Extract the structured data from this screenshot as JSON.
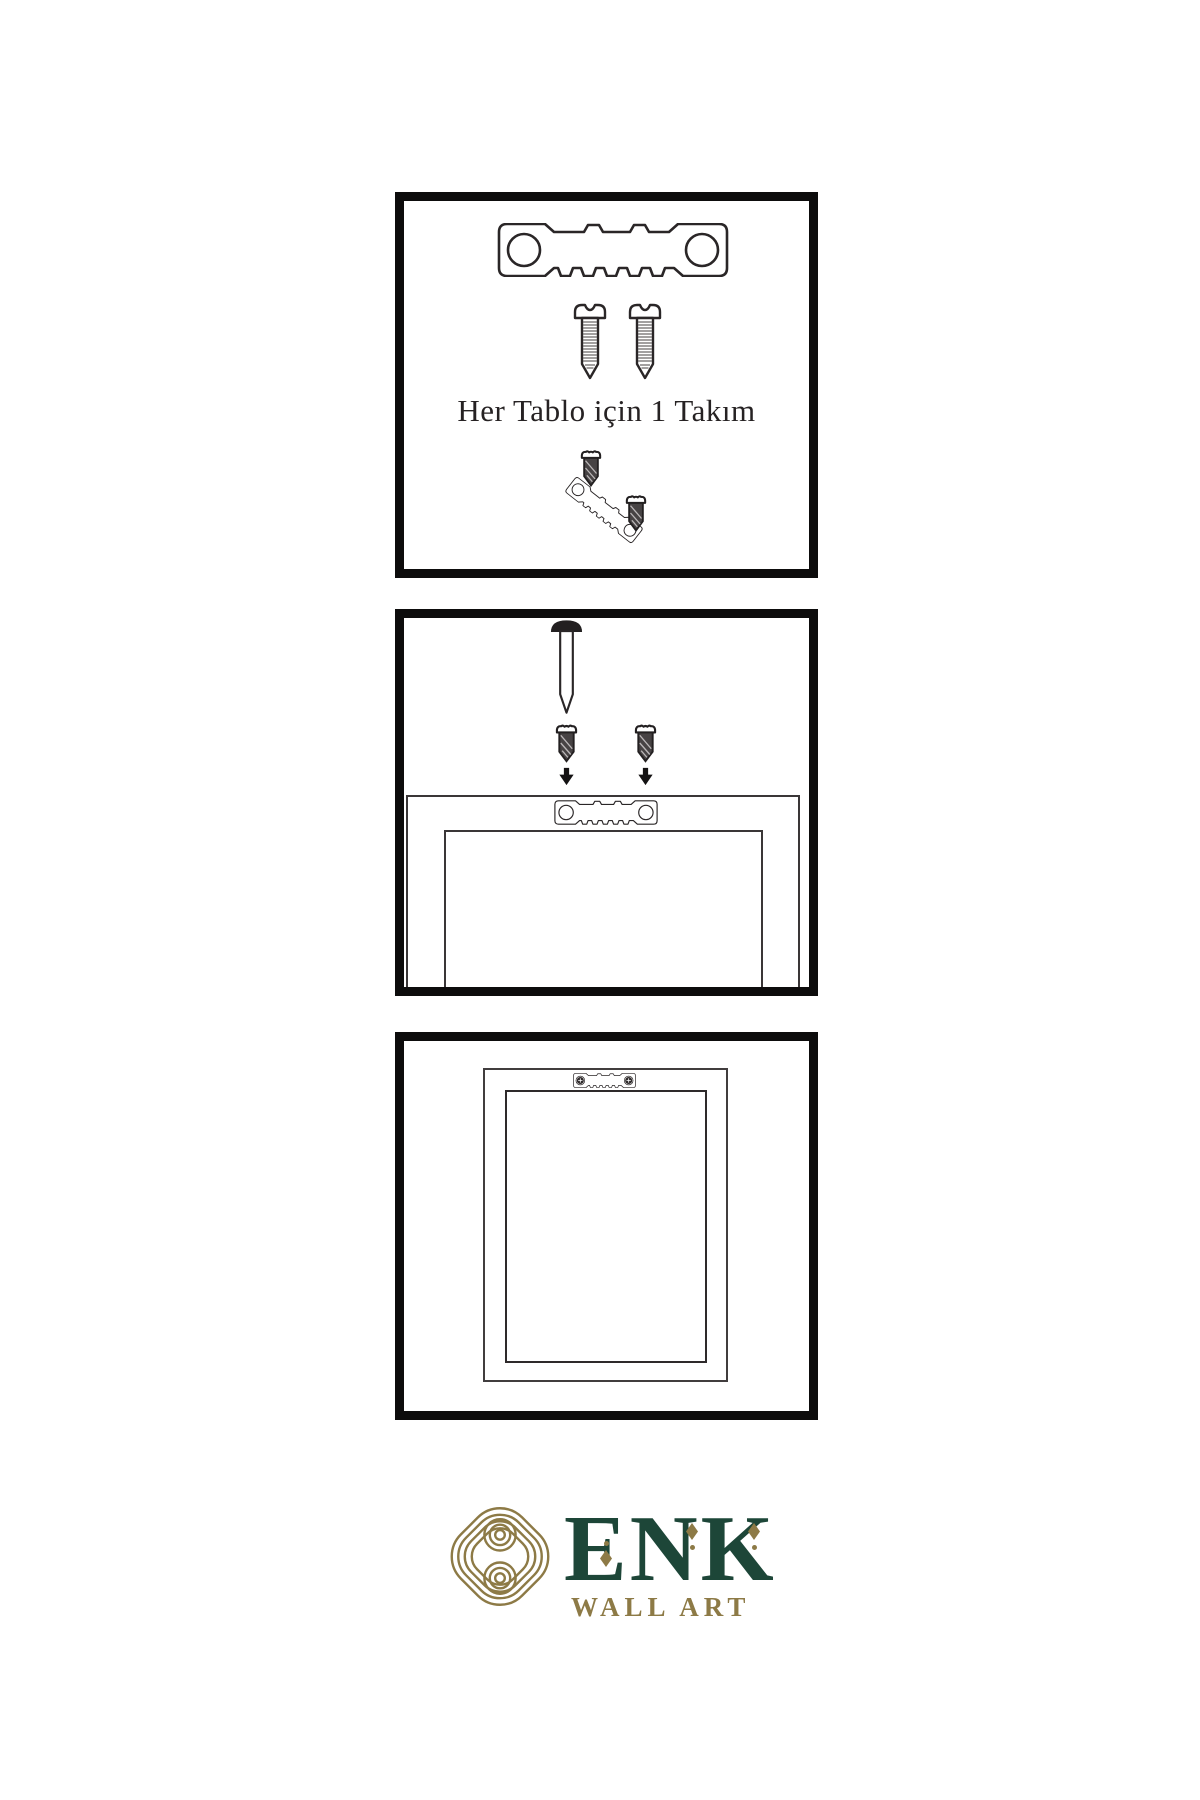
{
  "page": {
    "background": "#ffffff",
    "kind": "wall-art hanging instructions"
  },
  "step1": {
    "caption": "Her Tablo için 1 Takım",
    "icons": [
      "sawtooth-hanger-icon",
      "screw-icon",
      "screw-icon",
      "screw-dark-icon",
      "tilted-sawtooth-hanger-icon",
      "screw-dark-icon"
    ]
  },
  "step2": {
    "icons": [
      "wall-nail-icon",
      "screw-dark-icon",
      "screw-dark-icon",
      "arrow-down-icon",
      "arrow-down-icon",
      "frame-back-icon",
      "sawtooth-hanger-icon"
    ]
  },
  "step3": {
    "icons": [
      "frame-front-icon",
      "mounted-sawtooth-hanger-icon"
    ]
  },
  "logo": {
    "icon": "knot-logo-icon",
    "brand": "ENK",
    "subtitle": "WALL ART",
    "colors": {
      "green": "#1d4638",
      "gold": "#8d7a46"
    }
  },
  "colors": {
    "line_art": "#2a2627",
    "panel_border": "#0d0c0c",
    "screw_dark_fill": "#474344"
  }
}
